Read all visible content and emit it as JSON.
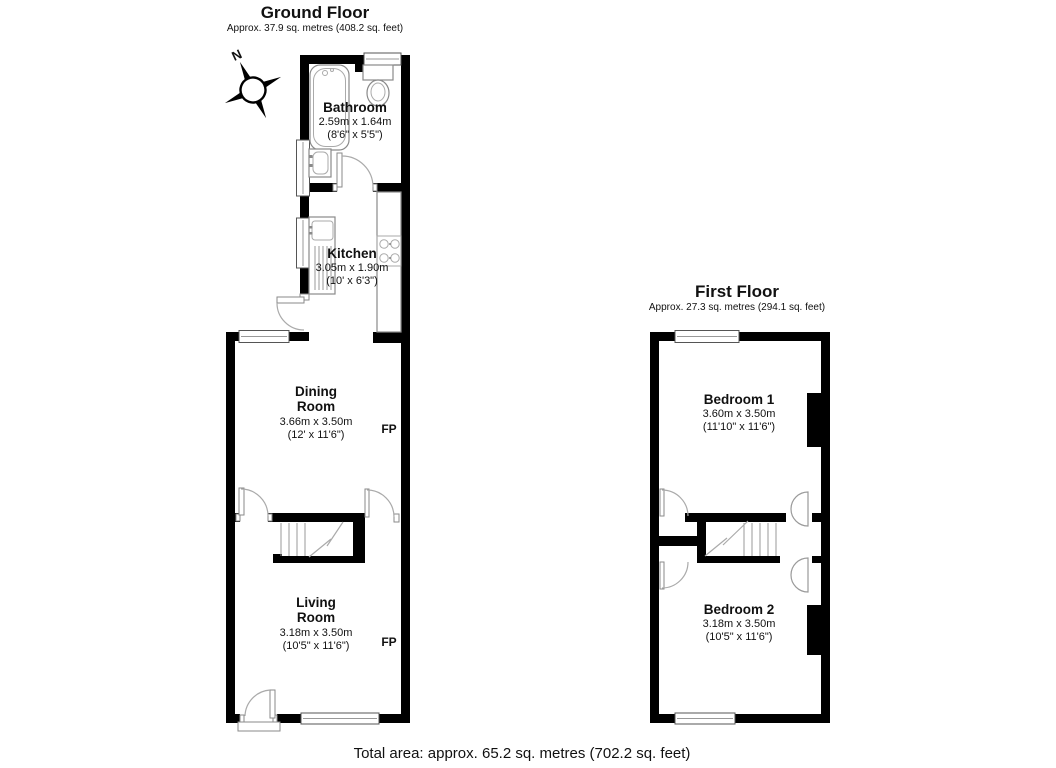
{
  "ground_floor": {
    "title": "Ground Floor",
    "subtitle": "Approx. 37.9 sq. metres (408.2 sq. feet)",
    "compass_north": "N",
    "rooms": {
      "bathroom": {
        "name": "Bathroom",
        "metric": "2.59m x 1.64m",
        "imperial": "(8'6\" x 5'5\")"
      },
      "kitchen": {
        "name": "Kitchen",
        "metric": "3.05m x 1.90m",
        "imperial": "(10' x 6'3\")"
      },
      "dining": {
        "line1": "Dining",
        "line2": "Room",
        "metric": "3.66m x 3.50m",
        "imperial": "(12' x 11'6\")",
        "fireplace": "FP"
      },
      "living": {
        "line1": "Living",
        "line2": "Room",
        "metric": "3.18m x 3.50m",
        "imperial": "(10'5\" x 11'6\")",
        "fireplace": "FP"
      }
    }
  },
  "first_floor": {
    "title": "First Floor",
    "subtitle": "Approx. 27.3 sq. metres (294.1 sq. feet)",
    "rooms": {
      "bedroom1": {
        "name": "Bedroom 1",
        "metric": "3.60m x 3.50m",
        "imperial": "(11'10\" x 11'6\")"
      },
      "bedroom2": {
        "name": "Bedroom 2",
        "metric": "3.18m x 3.50m",
        "imperial": "(10'5\" x 11'6\")"
      }
    }
  },
  "footer": {
    "total_area": "Total area: approx. 65.2 sq. metres (702.2 sq. feet)"
  },
  "colors": {
    "wall": "#000000",
    "fixture": "#8a8a8a",
    "text": "#111111"
  }
}
